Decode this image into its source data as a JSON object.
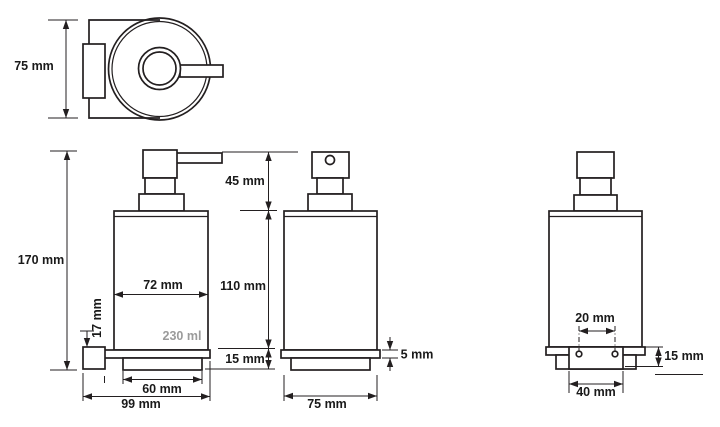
{
  "colors": {
    "line": "#231f20",
    "text": "#1a1a1a",
    "capacity_text": "#9b9b9b",
    "background": "#ffffff"
  },
  "views": {
    "top": {
      "height_label": "75 mm"
    },
    "front": {
      "overall_height": "170 mm",
      "pump_height": "45 mm",
      "body_width": "72 mm",
      "body_height": "110 mm",
      "bracket_height": "17 mm",
      "capacity": "230 ml",
      "base_height": "15 mm",
      "base_width": "60 mm",
      "overall_width": "99 mm"
    },
    "side": {
      "flange_thickness": "5 mm",
      "depth": "75 mm"
    },
    "rear": {
      "hole_spacing": "20 mm",
      "plate_height": "15 mm",
      "plate_width": "40 mm"
    }
  }
}
